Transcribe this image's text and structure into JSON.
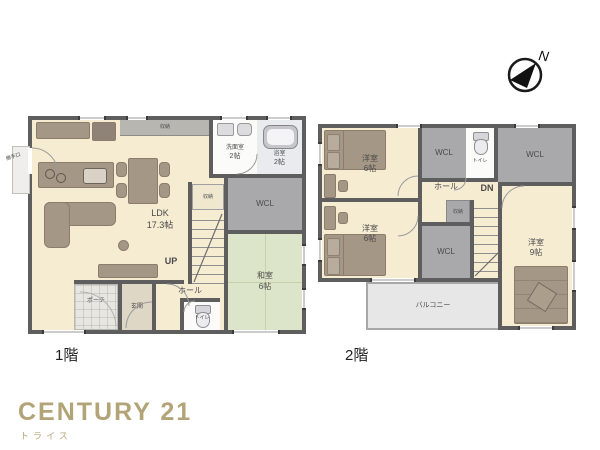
{
  "compass": {
    "north_label": "N"
  },
  "floor1": {
    "caption": "1階",
    "ldk": {
      "name": "LDK",
      "size": "17.3帖"
    },
    "washroom": {
      "name": "洗面室",
      "size": "2帖"
    },
    "bath": {
      "name": "浴室",
      "size": "2帖"
    },
    "wcl": {
      "name": "WCL"
    },
    "washitsu": {
      "name": "和室",
      "size": "6帖"
    },
    "hall": {
      "name": "ホール"
    },
    "toilet": {
      "name": "トイレ"
    },
    "entrance": {
      "name": "玄関"
    },
    "porch": {
      "name": "ポーチ"
    },
    "backdoor": {
      "name": "勝手口"
    },
    "storage_top": {
      "name": "収納"
    },
    "storage_stairs": {
      "name": "収納"
    },
    "stairs": {
      "direction": "UP"
    }
  },
  "floor2": {
    "caption": "2階",
    "bedroom_nw": {
      "name": "洋室",
      "size": "6帖"
    },
    "bedroom_sw": {
      "name": "洋室",
      "size": "6帖"
    },
    "bedroom_e": {
      "name": "洋室",
      "size": "9帖"
    },
    "wcl_top_left": {
      "name": "WCL"
    },
    "wcl_top_right": {
      "name": "WCL"
    },
    "wcl_middle": {
      "name": "WCL"
    },
    "toilet": {
      "name": "トイレ"
    },
    "hall": {
      "name": "ホール"
    },
    "stairs": {
      "direction": "DN"
    },
    "storage": {
      "name": "収納"
    },
    "balcony": {
      "name": "バルコニー"
    }
  },
  "branding": {
    "brand": "CENTURY 21",
    "company": "トライス"
  },
  "colors": {
    "wall": "#5e5e5e",
    "floor": "#f6ecd2",
    "tatami": "#dce5c9",
    "closet": "#a9a9ab",
    "furniture": "#a49786",
    "furniture_dark": "#8a7d6d",
    "balcony": "#e7e7e7",
    "bath": "#e9ebee",
    "white_room": "#fbfbfa",
    "entrance_floor": "#ded7c6",
    "porch": "#e8e6e1",
    "brand_gold": "#b3a478"
  }
}
